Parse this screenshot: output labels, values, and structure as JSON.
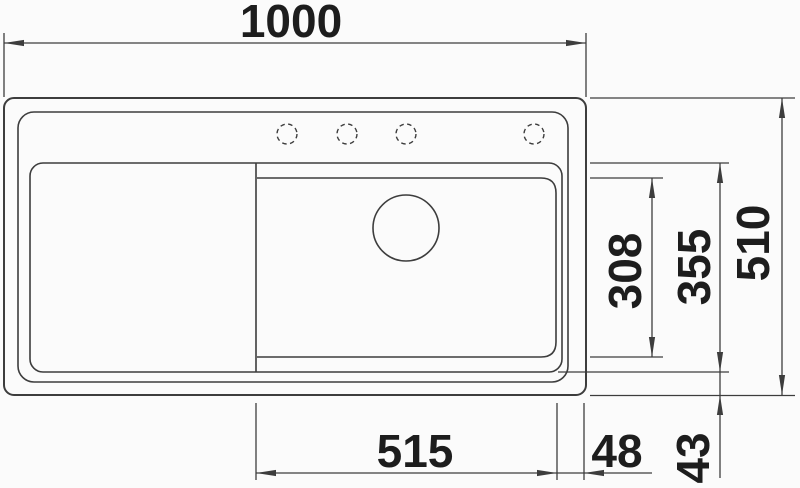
{
  "drawing": {
    "type": "technical-dimension-drawing",
    "subject": "kitchen-sink-top-view",
    "colors": {
      "background": "#fbfbfb",
      "line": "#3d3d3d",
      "text": "#1d1d1d"
    },
    "features": {
      "faucet_holes": 4,
      "drain_holes": 1,
      "bowls": 1,
      "drainboards": 1
    },
    "dimensions": [
      {
        "id": "overall-width",
        "label": "1000",
        "orientation": "horizontal",
        "position": "top"
      },
      {
        "id": "overall-depth",
        "label": "510",
        "orientation": "vertical",
        "position": "right"
      },
      {
        "id": "bowl-depth-outer",
        "label": "355",
        "orientation": "vertical",
        "position": "right"
      },
      {
        "id": "bowl-depth-inner",
        "label": "308",
        "orientation": "vertical",
        "position": "right"
      },
      {
        "id": "bowl-width",
        "label": "515",
        "orientation": "horizontal",
        "position": "bottom"
      },
      {
        "id": "bowl-to-right-edge",
        "label": "48",
        "orientation": "horizontal",
        "position": "bottom"
      },
      {
        "id": "bowl-to-bottom-edge",
        "label": "43",
        "orientation": "vertical",
        "position": "bottom-right"
      }
    ]
  }
}
